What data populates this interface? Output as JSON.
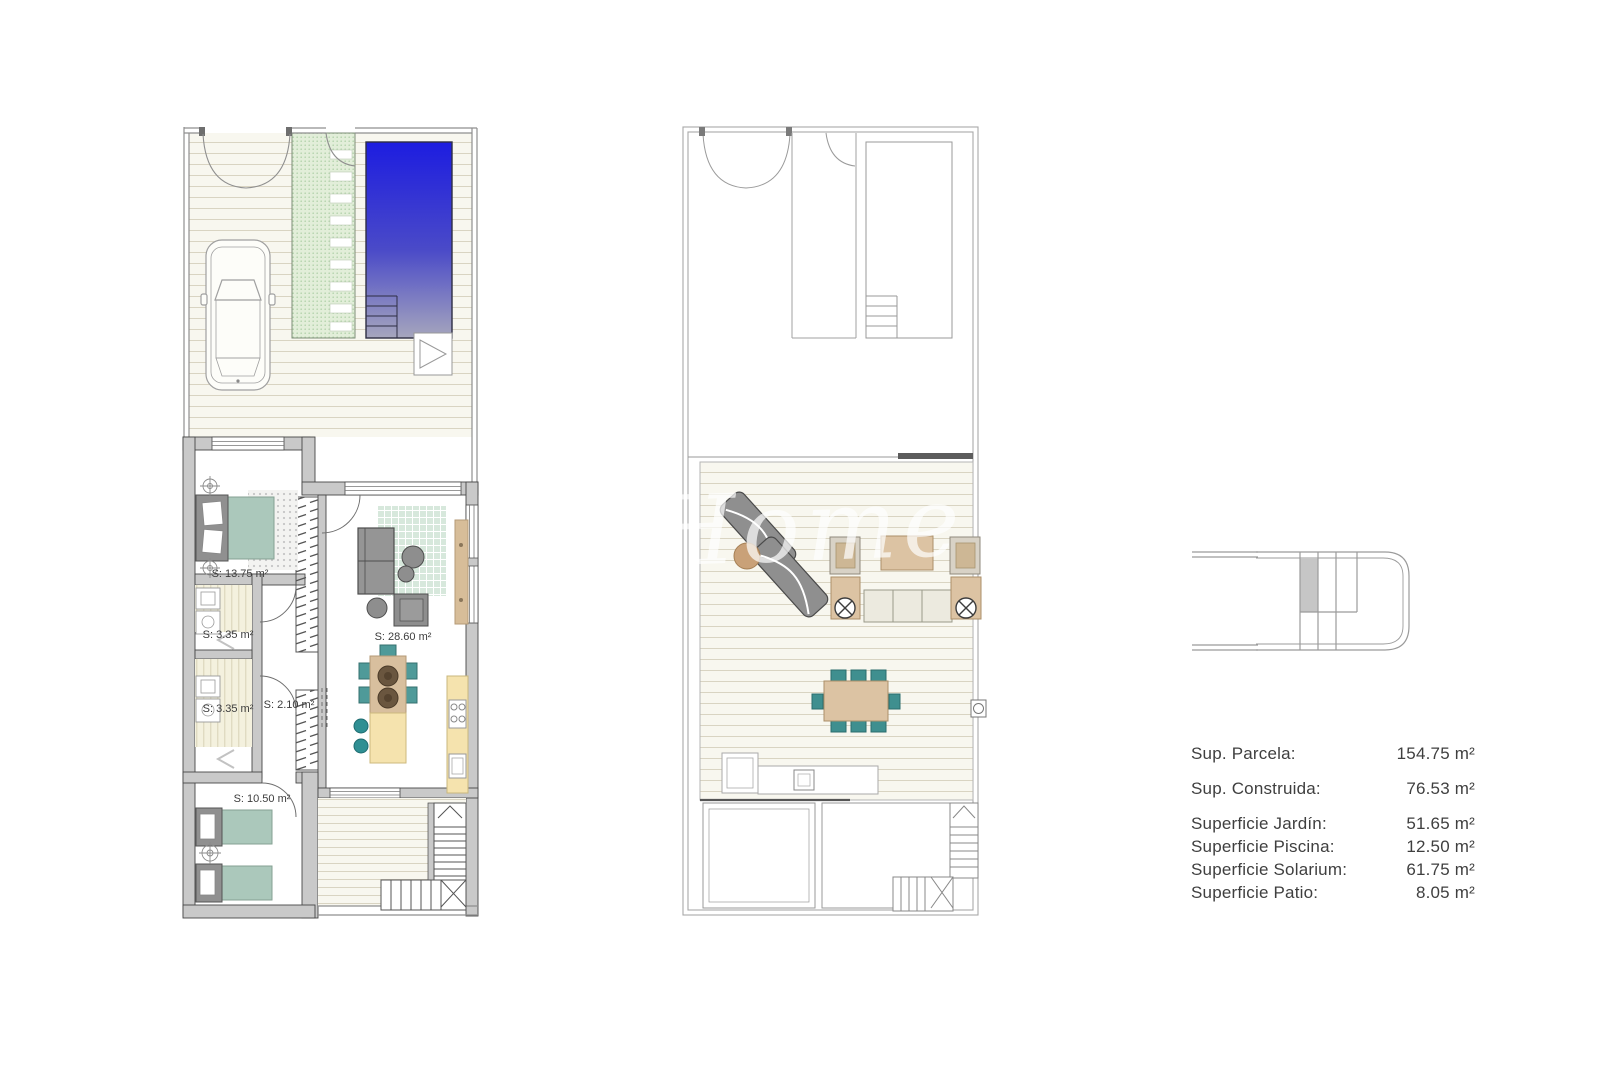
{
  "plans": {
    "ground": {
      "rooms": {
        "bedroom1": "S: 13.75 m²",
        "bath1": "S: 3.35 m²",
        "bath2": "S: 3.35 m²",
        "hall": "S: 2.10 m²",
        "living": "S: 28.60 m²",
        "bedroom2": "S: 10.50 m²"
      }
    }
  },
  "legend": {
    "rows": [
      {
        "label": "Sup. Parcela:",
        "value": "154.75 m²"
      },
      {
        "label": "Sup. Construida:",
        "value": "76.53 m²"
      },
      {
        "label": "Superficie Jardín:",
        "value": "51.65 m²"
      },
      {
        "label": "Superficie Piscina:",
        "value": "12.50 m²"
      },
      {
        "label": "Superficie Solarium:",
        "value": "61.75 m²"
      },
      {
        "label": "Superficie Patio:",
        "value": "8.05 m²"
      }
    ]
  },
  "watermark": {
    "text": "Home"
  },
  "colors": {
    "pool_top": "#1d1de0",
    "pool_bottom": "#a6a6bd",
    "teal": "#4f9a99",
    "bed_green": "#abc8bb",
    "wood_tan": "#d8bf9e",
    "kitchen_yellow": "#f5e3ae",
    "wall_gray": "#c9c9c9",
    "path_green": "#e2eed9"
  }
}
